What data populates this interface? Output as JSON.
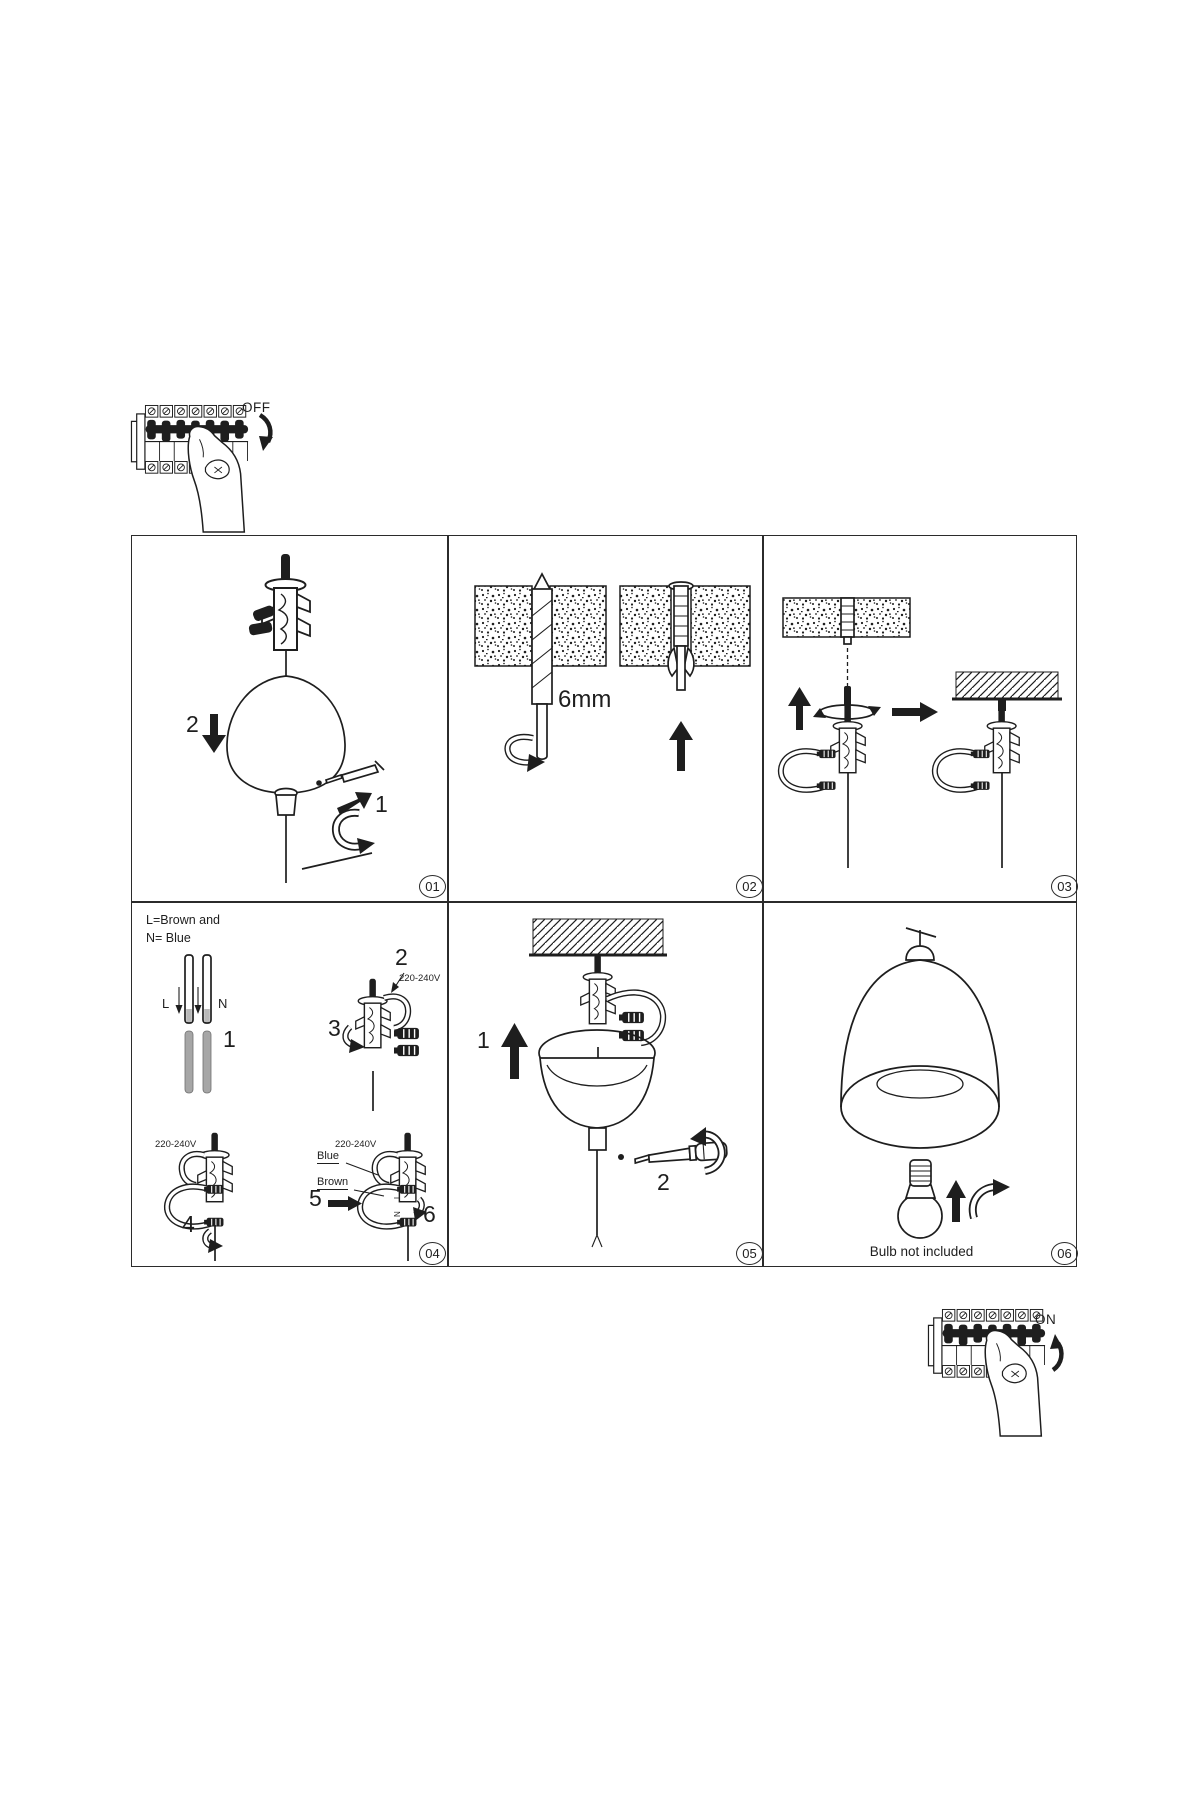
{
  "ink": "#1e1e1e",
  "power_off": {
    "label": "OFF"
  },
  "power_on": {
    "label": "ON"
  },
  "panels": {
    "p1": {
      "badge": "01",
      "step_down": "2",
      "step_rotate": "1"
    },
    "p2": {
      "badge": "02",
      "drill_size": "6mm"
    },
    "p3": {
      "badge": "03"
    },
    "p4": {
      "badge": "04",
      "note_line1": "L=Brown and",
      "note_line2": "N= Blue",
      "label_l": "L",
      "label_n": "N",
      "voltage": "220-240V",
      "label_blue": "Blue",
      "label_brown": "Brown",
      "step1": "1",
      "step2": "2",
      "step3": "3",
      "step4": "4",
      "step5": "5",
      "step6": "6",
      "term_l": "L",
      "term_n": "N"
    },
    "p5": {
      "badge": "05",
      "step1": "1",
      "step2": "2"
    },
    "p6": {
      "badge": "06",
      "note": "Bulb not included"
    }
  }
}
